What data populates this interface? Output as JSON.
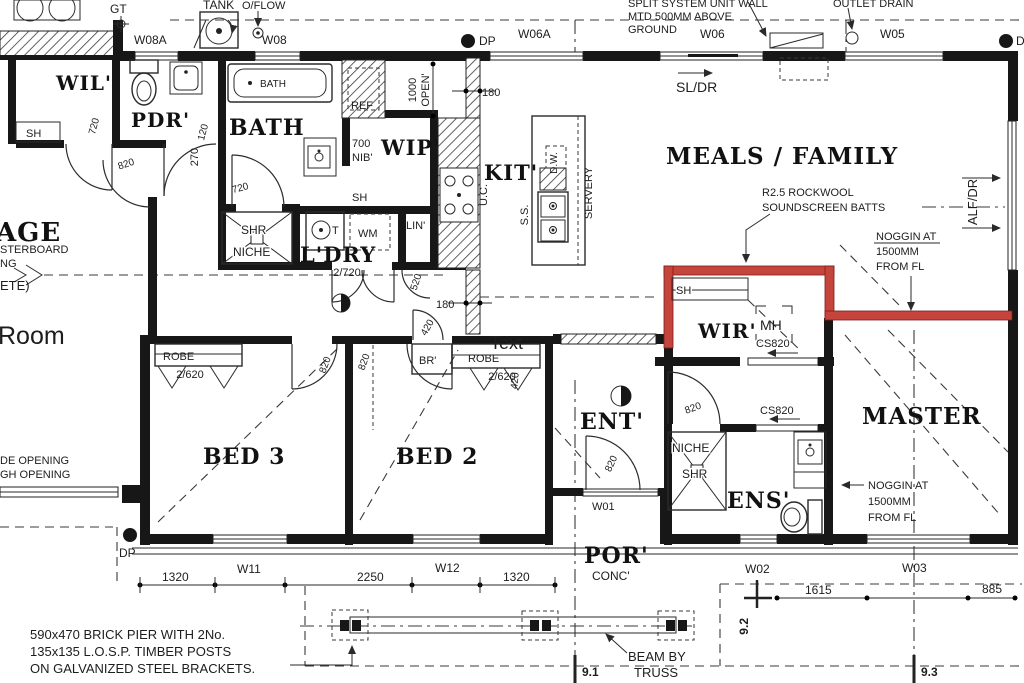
{
  "colors": {
    "ink": "#1d1d1d",
    "highlight": "#c5443c",
    "paper": "#ffffff"
  },
  "rooms": {
    "wil": "WIL'",
    "pdr": "PDR'",
    "bath": "BATH",
    "wip": "WIP'",
    "kit": "KIT'",
    "ldry": "L'DRY",
    "meals": "MEALS / FAMILY",
    "bed3": "BED 3",
    "bed2": "BED 2",
    "ent": "ENT'",
    "wir": "WIR'",
    "master": "MASTER",
    "ens": "ENS'",
    "por": "POR'",
    "por_floor": "CONC'",
    "garage_cut": "AGE",
    "room_cut": "Room"
  },
  "windows": {
    "w01": "W01",
    "w02": "W02",
    "w03": "W03",
    "w05": "W05",
    "w06": "W06",
    "w06a": "W06A",
    "w08": "W08",
    "w08a": "W08A",
    "w11": "W11",
    "w12": "W12"
  },
  "dims": {
    "d120": "120",
    "d180": "180",
    "d270": "270",
    "d420": "420",
    "d520": "520",
    "d700": "700",
    "d720": "720",
    "d820": "820",
    "d885": "885",
    "d1000": "1000",
    "d1320": "1320",
    "d1615": "1615",
    "d2250": "2250",
    "d2_620": "2/620",
    "d2_720": "2/720",
    "open": "OPEN'",
    "nib": "NIB'",
    "s1": "9.1",
    "s2": "9.2",
    "s3": "9.3"
  },
  "fixtures": {
    "sh": "SH",
    "ref": "REF",
    "lin": "LIN'",
    "wm": "WM",
    "t": "T",
    "shr": "SHR",
    "niche": "NICHE",
    "br": "BR'",
    "robe": "ROBE",
    "mh": "MH",
    "cs820": "CS820",
    "uc": "U.C.",
    "ss": "S.S.",
    "dw": "D.W.",
    "servery": "SERVERY",
    "tub": "BATH",
    "dp": "DP",
    "gt": "GT",
    "tank": "TANK",
    "oflow": "O/FLOW"
  },
  "notes": {
    "split_1": "SPLIT SYSTEM UNIT WALL",
    "split_2": "MTD 500MM ABOVE",
    "split_3": "GROUND",
    "outlet_drain": "OUTLET DRAIN",
    "sl_dr": "SL/DR",
    "alf_dr": "ALF/DR",
    "rockwool_1": "R2.5 ROCKWOOL",
    "rockwool_2": "SOUNDSCREEN BATTS",
    "noggin_1": "NOGGIN AT",
    "noggin_2": "1500MM",
    "noggin_3": "FROM FL",
    "pier_1": "590x470 BRICK PIER WITH 2No.",
    "pier_2": "135x135 L.O.S.P. TIMBER POSTS",
    "pier_3": "ON GALVANIZED STEEL BRACKETS.",
    "beam_1": "BEAM BY",
    "beam_2": "TRUSS",
    "opening_1": "DE OPENING",
    "opening_2": "GH OPENING",
    "plaster_1": "STERBOARD",
    "plaster_2": "NG",
    "plaster_3": "ETE)"
  },
  "annotations": {
    "text_tool": "Text"
  }
}
